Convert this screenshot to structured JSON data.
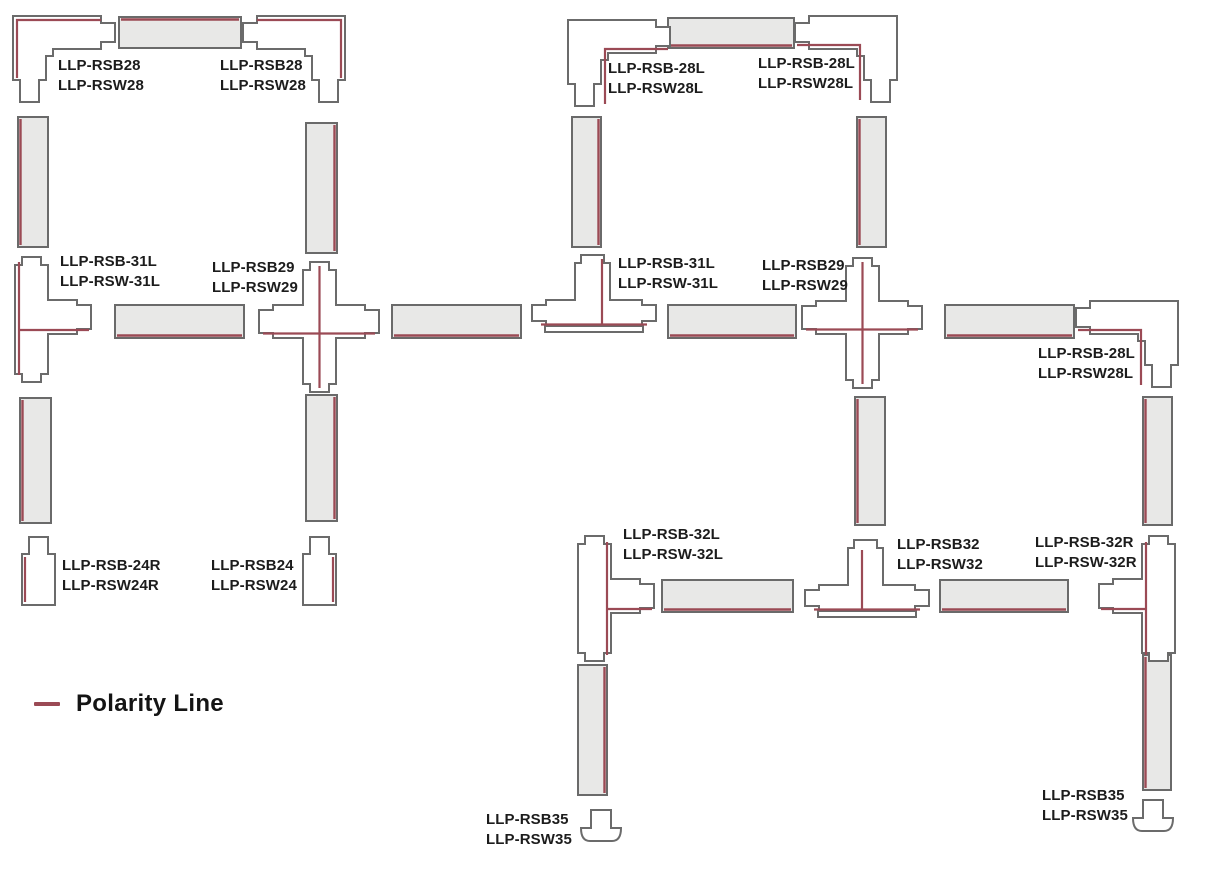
{
  "legend": {
    "label": "Polarity Line"
  },
  "colors": {
    "polarity_line": "#9b4a55",
    "outline": "#6b6b6b",
    "track_fill": "#e8e8e7"
  },
  "labels": [
    {
      "kind": "corner-connector",
      "line1": "LLP-RSB28",
      "line2": "LLP-RSW28"
    },
    {
      "kind": "corner-connector",
      "line1": "LLP-RSB28",
      "line2": "LLP-RSW28"
    },
    {
      "kind": "tee-connector",
      "line1": "LLP-RSB-31L",
      "line2": "LLP-RSW-31L"
    },
    {
      "kind": "cross-connector",
      "line1": "LLP-RSB29",
      "line2": "LLP-RSW29"
    },
    {
      "kind": "end-cap",
      "line1": "LLP-RSB-24R",
      "line2": "LLP-RSW24R"
    },
    {
      "kind": "end-cap",
      "line1": "LLP-RSB24",
      "line2": "LLP-RSW24"
    },
    {
      "kind": "corner-connector",
      "line1": "LLP-RSB-28L",
      "line2": "LLP-RSW28L"
    },
    {
      "kind": "corner-connector",
      "line1": "LLP-RSB-28L",
      "line2": "LLP-RSW28L"
    },
    {
      "kind": "tee-connector",
      "line1": "LLP-RSB-31L",
      "line2": "LLP-RSW-31L"
    },
    {
      "kind": "cross-connector",
      "line1": "LLP-RSB29",
      "line2": "LLP-RSW29"
    },
    {
      "kind": "corner-connector",
      "line1": "LLP-RSB-28L",
      "line2": "LLP-RSW28L"
    },
    {
      "kind": "tee-connector",
      "line1": "LLP-RSB-32L",
      "line2": "LLP-RSW-32L"
    },
    {
      "kind": "tee-connector",
      "line1": "LLP-RSB32",
      "line2": "LLP-RSW32"
    },
    {
      "kind": "tee-connector",
      "line1": "LLP-RSB-32R",
      "line2": "LLP-RSW-32R"
    },
    {
      "kind": "end-cap",
      "line1": "LLP-RSB35",
      "line2": "LLP-RSW35"
    },
    {
      "kind": "end-cap",
      "line1": "LLP-RSB35",
      "line2": "LLP-RSW35"
    }
  ]
}
